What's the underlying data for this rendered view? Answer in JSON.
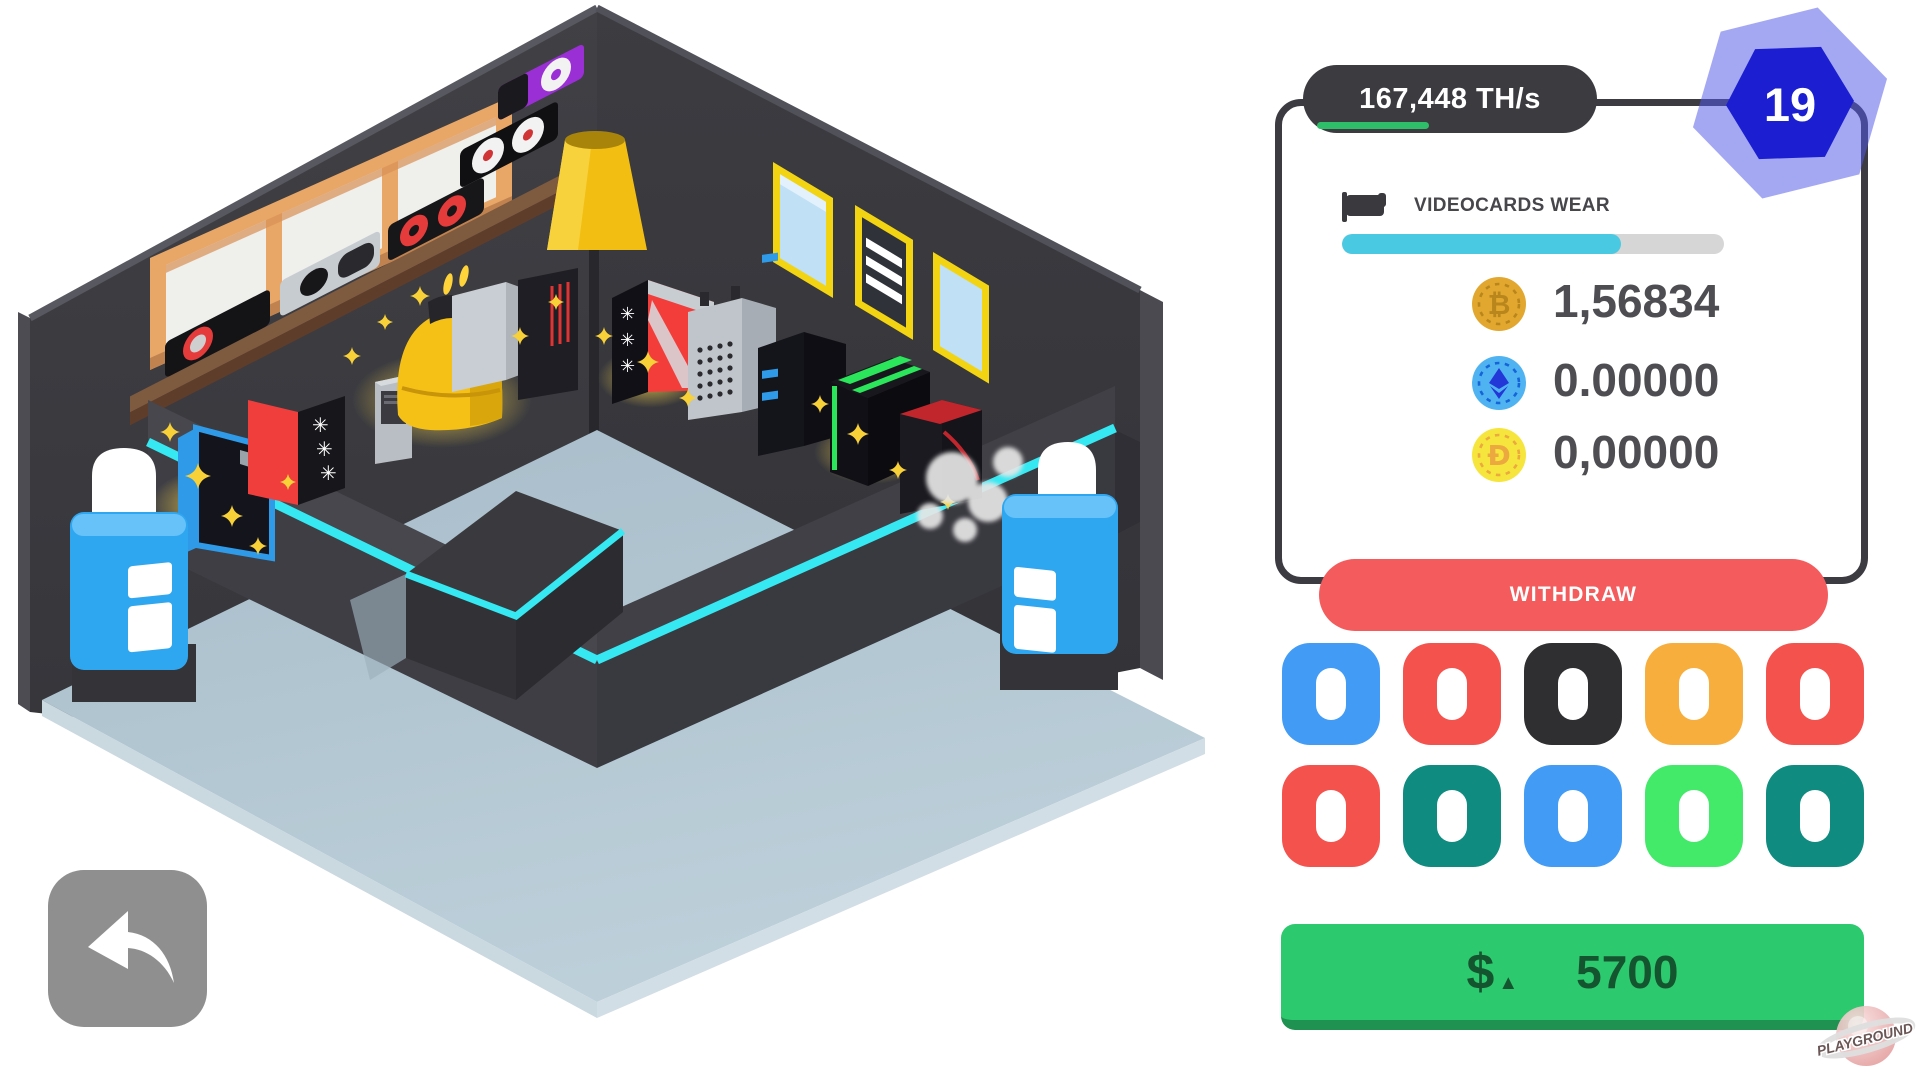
{
  "header": {
    "hashrate": "167,448 TH/s",
    "level": "19",
    "hash_progress_percent": 42
  },
  "wear": {
    "label": "VIDEOCARDS WEAR",
    "percent": 73
  },
  "balances": [
    {
      "id": "bitcoin",
      "symbol": "₿",
      "value": "1,56834"
    },
    {
      "id": "ethereum",
      "symbol": "♦",
      "value": "0.00000"
    },
    {
      "id": "dogecoin",
      "symbol": "Ð",
      "value": "0,00000"
    }
  ],
  "withdraw_label": "WITHDRAW",
  "buy": {
    "currency": "$",
    "trend": "▲",
    "amount": "5700"
  },
  "palette": {
    "row1": [
      "#429bf4",
      "#f4524d",
      "#2f2f31",
      "#f7ae3c",
      "#f4524d"
    ],
    "row2": [
      "#f4524d",
      "#0f8b80",
      "#429bf4",
      "#43e969",
      "#0f8b80"
    ]
  },
  "watermark": "PLAYGROUND",
  "colors": {
    "accent_cyan": "#4ac9e3",
    "accent_green": "#2ebd68",
    "neon": "#35e8f2",
    "button_green": "#2dc96e",
    "button_red": "#f45b5c",
    "hex_inner": "#1b1fd1",
    "hex_outer": "#5058e8"
  }
}
